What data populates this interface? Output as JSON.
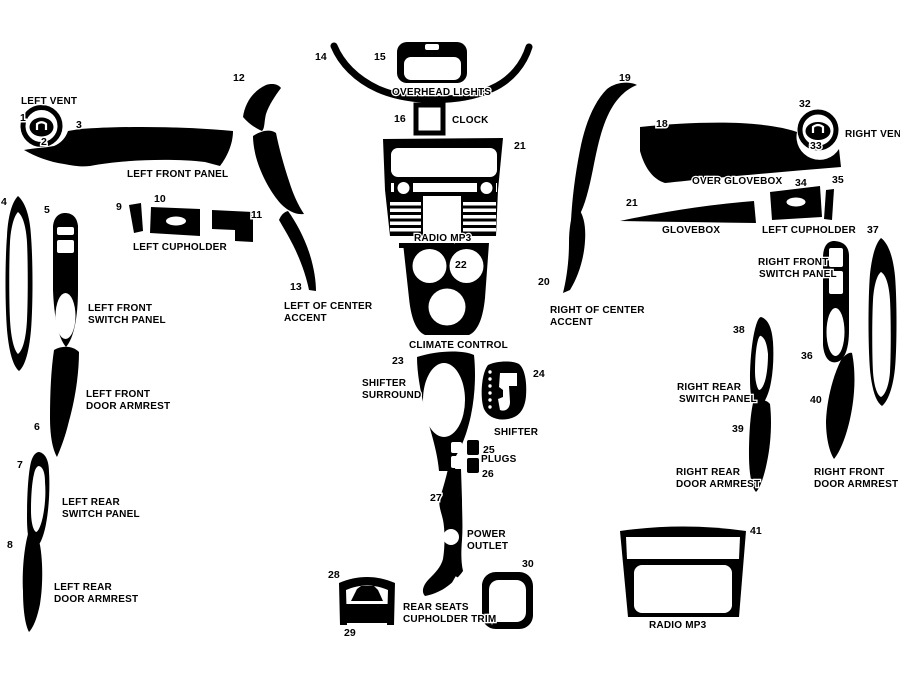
{
  "diagram": {
    "background": "#ffffff",
    "ink": "#000000",
    "numbers": [
      {
        "t": "1",
        "x": 20,
        "y": 121
      },
      {
        "t": "2",
        "x": 41,
        "y": 145
      },
      {
        "t": "3",
        "x": 76,
        "y": 128
      },
      {
        "t": "4",
        "x": 1,
        "y": 205
      },
      {
        "t": "5",
        "x": 44,
        "y": 213
      },
      {
        "t": "6",
        "x": 34,
        "y": 430
      },
      {
        "t": "7",
        "x": 17,
        "y": 468
      },
      {
        "t": "8",
        "x": 7,
        "y": 548
      },
      {
        "t": "9",
        "x": 116,
        "y": 210
      },
      {
        "t": "10",
        "x": 154,
        "y": 202
      },
      {
        "t": "11",
        "x": 251,
        "y": 218
      },
      {
        "t": "12",
        "x": 233,
        "y": 81
      },
      {
        "t": "13",
        "x": 290,
        "y": 290
      },
      {
        "t": "14",
        "x": 315,
        "y": 60
      },
      {
        "t": "15",
        "x": 374,
        "y": 60
      },
      {
        "t": "16",
        "x": 394,
        "y": 122
      },
      {
        "t": "21",
        "x": 514,
        "y": 149
      },
      {
        "t": "18",
        "x": 656,
        "y": 127
      },
      {
        "t": "19",
        "x": 619,
        "y": 81
      },
      {
        "t": "20",
        "x": 538,
        "y": 285
      },
      {
        "t": "21",
        "x": 626,
        "y": 206
      },
      {
        "t": "22",
        "x": 455,
        "y": 268
      },
      {
        "t": "23",
        "x": 392,
        "y": 364
      },
      {
        "t": "24",
        "x": 533,
        "y": 377
      },
      {
        "t": "25",
        "x": 483,
        "y": 453
      },
      {
        "t": "26",
        "x": 482,
        "y": 477
      },
      {
        "t": "27",
        "x": 430,
        "y": 501
      },
      {
        "t": "28",
        "x": 328,
        "y": 578
      },
      {
        "t": "29",
        "x": 344,
        "y": 636
      },
      {
        "t": "30",
        "x": 522,
        "y": 567
      },
      {
        "t": "32",
        "x": 799,
        "y": 107
      },
      {
        "t": "33",
        "x": 810,
        "y": 149
      },
      {
        "t": "34",
        "x": 795,
        "y": 186
      },
      {
        "t": "35",
        "x": 832,
        "y": 183
      },
      {
        "t": "36",
        "x": 801,
        "y": 359
      },
      {
        "t": "37",
        "x": 867,
        "y": 233
      },
      {
        "t": "38",
        "x": 733,
        "y": 333
      },
      {
        "t": "39",
        "x": 732,
        "y": 432
      },
      {
        "t": "40",
        "x": 810,
        "y": 403
      },
      {
        "t": "41",
        "x": 750,
        "y": 534
      }
    ],
    "labels": [
      {
        "t": "LEFT VENT",
        "x": 21,
        "y": 104
      },
      {
        "t": "LEFT FRONT PANEL",
        "x": 127,
        "y": 177
      },
      {
        "t": "LEFT CUPHOLDER",
        "x": 133,
        "y": 250
      },
      {
        "t": "LEFT FRONT",
        "x": 88,
        "y": 311
      },
      {
        "t": "SWITCH PANEL",
        "x": 88,
        "y": 323
      },
      {
        "t": "LEFT FRONT",
        "x": 86,
        "y": 397
      },
      {
        "t": "DOOR ARMREST",
        "x": 86,
        "y": 409
      },
      {
        "t": "LEFT REAR",
        "x": 62,
        "y": 505
      },
      {
        "t": "SWITCH PANEL",
        "x": 62,
        "y": 517
      },
      {
        "t": "LEFT REAR",
        "x": 54,
        "y": 590
      },
      {
        "t": "DOOR ARMREST",
        "x": 54,
        "y": 602
      },
      {
        "t": "OVERHEAD LIGHTS",
        "x": 392,
        "y": 95
      },
      {
        "t": "CLOCK",
        "x": 452,
        "y": 123
      },
      {
        "t": "RADIO MP3",
        "x": 414,
        "y": 241
      },
      {
        "t": "CLIMATE CONTROL",
        "x": 409,
        "y": 348
      },
      {
        "t": "LEFT OF CENTER",
        "x": 284,
        "y": 309
      },
      {
        "t": "ACCENT",
        "x": 284,
        "y": 321
      },
      {
        "t": "SHIFTER",
        "x": 362,
        "y": 386
      },
      {
        "t": "SURROUND",
        "x": 362,
        "y": 398
      },
      {
        "t": "SHIFTER",
        "x": 494,
        "y": 435
      },
      {
        "t": "PLUGS",
        "x": 481,
        "y": 462
      },
      {
        "t": "POWER",
        "x": 467,
        "y": 537
      },
      {
        "t": "OUTLET",
        "x": 467,
        "y": 549
      },
      {
        "t": "REAR SEATS",
        "x": 403,
        "y": 610
      },
      {
        "t": "CUPHOLDER TRIM",
        "x": 403,
        "y": 622
      },
      {
        "t": "RIGHT OF CENTER",
        "x": 550,
        "y": 313
      },
      {
        "t": "ACCENT",
        "x": 550,
        "y": 325
      },
      {
        "t": "OVER GLOVEBOX",
        "x": 692,
        "y": 184
      },
      {
        "t": "GLOVEBOX",
        "x": 662,
        "y": 233
      },
      {
        "t": "LEFT CUPHOLDER",
        "x": 762,
        "y": 233
      },
      {
        "t": "RIGHT VENT",
        "x": 845,
        "y": 137
      },
      {
        "t": "RIGHT FRONT",
        "x": 758,
        "y": 265
      },
      {
        "t": "SWITCH PANEL",
        "x": 759,
        "y": 277
      },
      {
        "t": "RIGHT REAR",
        "x": 677,
        "y": 390
      },
      {
        "t": "SWITCH PANEL",
        "x": 679,
        "y": 402
      },
      {
        "t": "RIGHT REAR",
        "x": 676,
        "y": 475
      },
      {
        "t": "DOOR ARMREST",
        "x": 676,
        "y": 487
      },
      {
        "t": "RIGHT FRONT",
        "x": 814,
        "y": 475
      },
      {
        "t": "DOOR ARMREST",
        "x": 814,
        "y": 487
      },
      {
        "t": "RADIO MP3",
        "x": 649,
        "y": 628
      }
    ]
  }
}
